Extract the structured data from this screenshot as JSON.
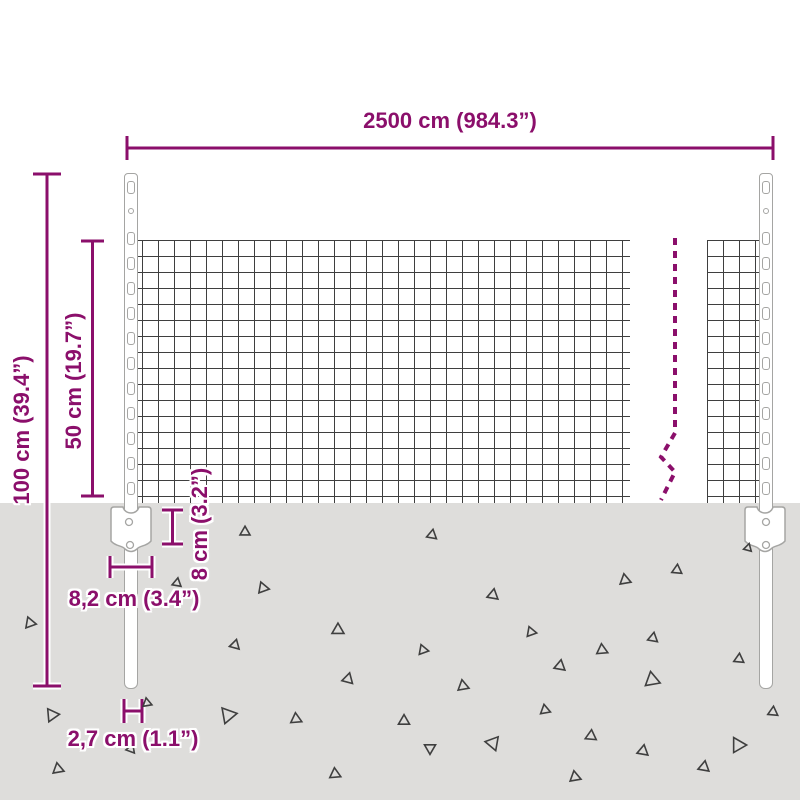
{
  "title": "Wire mesh fence panel dimension diagram",
  "colors": {
    "dimension": "#8b0f6b",
    "ground": "#dedddb",
    "mesh_line": "#3f3f3f",
    "steel_outline": "#a5a5a3",
    "triangle": "#3f3f3f"
  },
  "dimensions": {
    "width": {
      "label": "2500 cm (984.3”)"
    },
    "total_height": {
      "label": "100 cm (39.4”)"
    },
    "mesh_height": {
      "label": "50 cm (19.7”)"
    },
    "anchor_plate_height": {
      "label": "8 cm (3.2”)"
    },
    "anchor_plate_width": {
      "label": "8,2 cm (3.4”)"
    },
    "post_width": {
      "label": "2,7 cm (1.1”)"
    }
  },
  "fence": {
    "post_xs": [
      124,
      759
    ],
    "post_feature_ys": {
      "top_slot": 188,
      "hole": 211,
      "clips": [
        238,
        263,
        288,
        313,
        338,
        363,
        388,
        413,
        438,
        463,
        488
      ]
    }
  },
  "decorations": {
    "triangles": [
      {
        "x": 245,
        "y": 532,
        "s": 10,
        "r": 0
      },
      {
        "x": 432,
        "y": 535,
        "s": 10,
        "r": 10
      },
      {
        "x": 263,
        "y": 588,
        "s": 11,
        "r": 100
      },
      {
        "x": 493,
        "y": 595,
        "s": 11,
        "r": 250
      },
      {
        "x": 338,
        "y": 630,
        "s": 12,
        "r": 120
      },
      {
        "x": 235,
        "y": 645,
        "s": 10,
        "r": 255
      },
      {
        "x": 423,
        "y": 650,
        "s": 10,
        "r": 100
      },
      {
        "x": 348,
        "y": 679,
        "s": 11,
        "r": 15
      },
      {
        "x": 463,
        "y": 686,
        "s": 11,
        "r": 230
      },
      {
        "x": 228,
        "y": 715,
        "s": 16,
        "r": 200
      },
      {
        "x": 296,
        "y": 719,
        "s": 11,
        "r": 115
      },
      {
        "x": 404,
        "y": 721,
        "s": 11,
        "r": 240
      },
      {
        "x": 430,
        "y": 748,
        "s": 11,
        "r": 60
      },
      {
        "x": 493,
        "y": 743,
        "s": 14,
        "r": 280
      },
      {
        "x": 335,
        "y": 774,
        "s": 11,
        "r": 115
      },
      {
        "x": 677,
        "y": 570,
        "s": 10,
        "r": 5
      },
      {
        "x": 625,
        "y": 580,
        "s": 11,
        "r": 110
      },
      {
        "x": 531,
        "y": 632,
        "s": 10,
        "r": 100
      },
      {
        "x": 602,
        "y": 650,
        "s": 11,
        "r": 115
      },
      {
        "x": 653,
        "y": 638,
        "s": 10,
        "r": 10
      },
      {
        "x": 560,
        "y": 666,
        "s": 11,
        "r": 250
      },
      {
        "x": 652,
        "y": 680,
        "s": 15,
        "r": 110
      },
      {
        "x": 739,
        "y": 659,
        "s": 10,
        "r": 245
      },
      {
        "x": 545,
        "y": 710,
        "s": 10,
        "r": 110
      },
      {
        "x": 773,
        "y": 712,
        "s": 10,
        "r": 5
      },
      {
        "x": 591,
        "y": 736,
        "s": 11,
        "r": 245
      },
      {
        "x": 643,
        "y": 751,
        "s": 11,
        "r": 250
      },
      {
        "x": 738,
        "y": 745,
        "s": 15,
        "r": 210
      },
      {
        "x": 704,
        "y": 767,
        "s": 11,
        "r": 250
      },
      {
        "x": 575,
        "y": 777,
        "s": 11,
        "r": 110
      },
      {
        "x": 748,
        "y": 548,
        "s": 8,
        "r": 15
      },
      {
        "x": 30,
        "y": 623,
        "s": 11,
        "r": 100
      },
      {
        "x": 52,
        "y": 715,
        "s": 13,
        "r": 205
      },
      {
        "x": 58,
        "y": 769,
        "s": 11,
        "r": 110
      },
      {
        "x": 147,
        "y": 703,
        "s": 9,
        "r": 110
      },
      {
        "x": 177,
        "y": 583,
        "s": 9,
        "r": 250
      },
      {
        "x": 131,
        "y": 749,
        "s": 9,
        "r": 140
      }
    ]
  }
}
